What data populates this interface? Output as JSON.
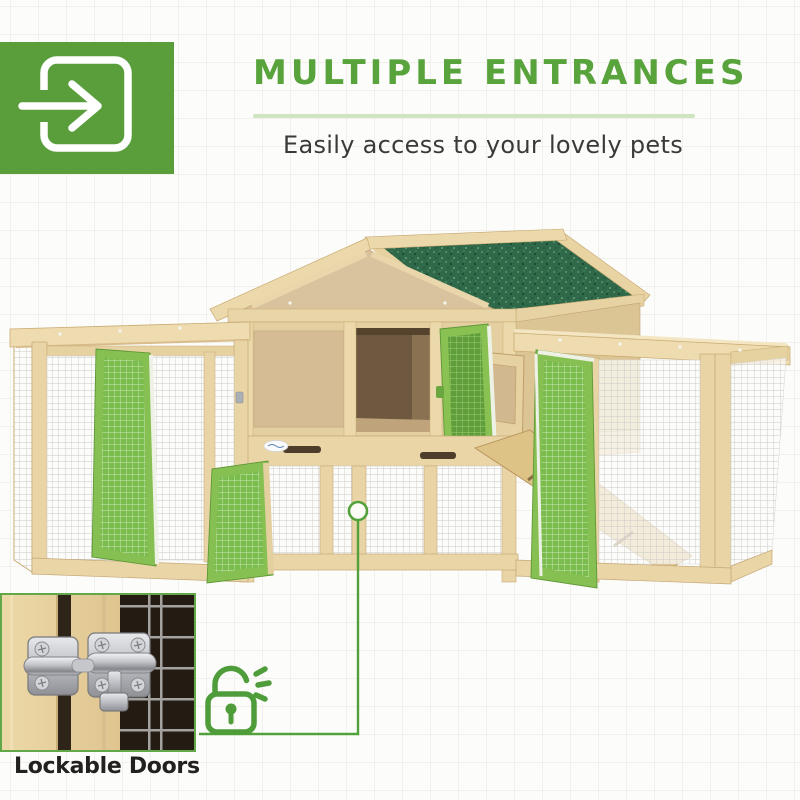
{
  "page": {
    "background": "#fcfcfa",
    "grid_color": "#f1f0ed"
  },
  "header": {
    "badge": {
      "icon": "enter-arrow-icon",
      "bg_color": "#5a9e3c",
      "glyph_color": "#ffffff"
    },
    "title": "MULTIPLE ENTRANCES",
    "title_color": "#58a33c",
    "divider_color": "#cfe5c0",
    "subtitle": "Easily access to your lovely pets",
    "subtitle_color": "#3a3a3a"
  },
  "product": {
    "description": "Wooden pet hutch: center house with green asphalt gable roof, wire-mesh runs on both sides, four open green mesh doors, side nest door and interior wooden ramp",
    "colors": {
      "wood": "#e8d4a5",
      "wood_dark": "#c6a877",
      "plywood_panel": "#d6bd96",
      "roof_green": "#30694a",
      "door_green": "#87c052",
      "door_mesh_green": "#7abc4e",
      "wire_mesh": "#c9c9c6",
      "interior_shadow": "#6e5940"
    },
    "callout": {
      "marker": "circle-marker",
      "line": "elbow-connector",
      "color": "#52a13a"
    }
  },
  "inset": {
    "subject": "metal slide-bolt latch on wooden mesh door",
    "border_color": "#63a848",
    "lock_icon": {
      "name": "unlock-icon",
      "color": "#4f9d3a"
    },
    "caption": "Lockable Doors",
    "caption_color": "#23211f"
  }
}
